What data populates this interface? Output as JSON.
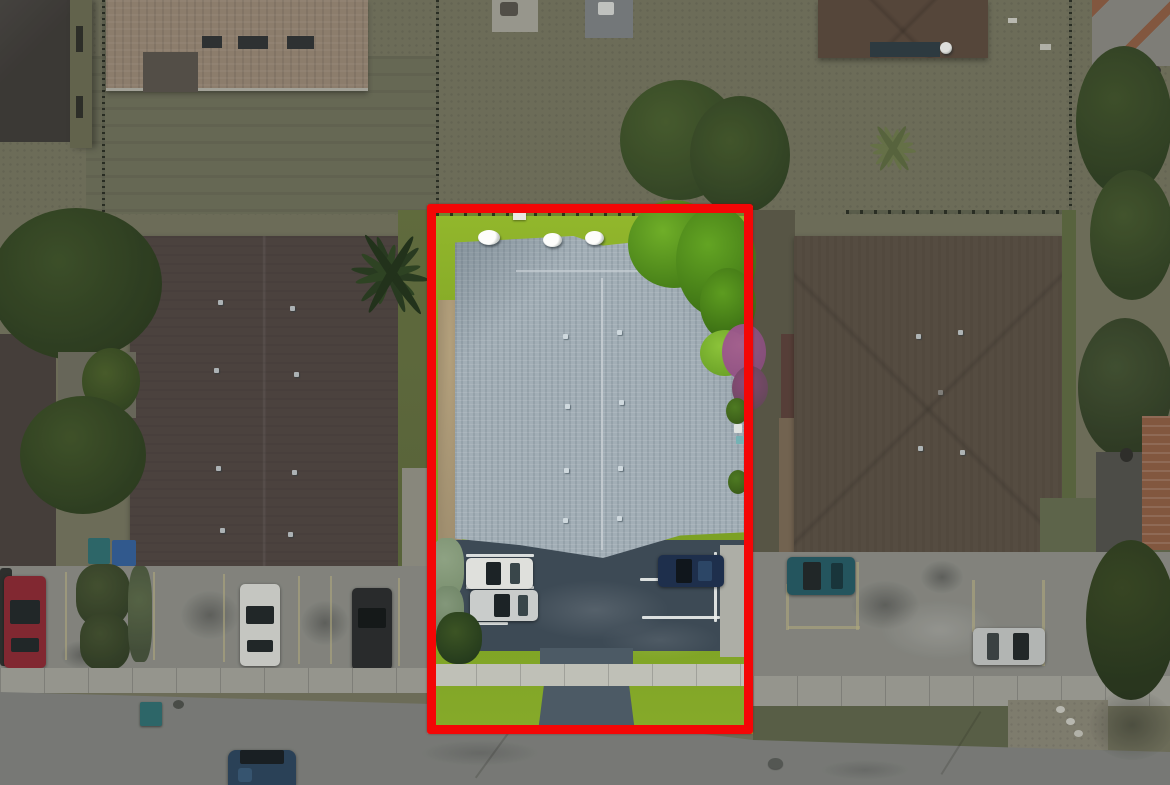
{
  "scene": {
    "type": "aerial-drone-photo",
    "subject": "multifamily property parcel outlined in red",
    "setting": "residential neighborhood with street at bottom",
    "effect": "area outside the red boundary is dimmed and desaturated"
  },
  "boundary": {
    "shape": "rectangle",
    "color": "#f40606",
    "x": 427,
    "y": 204,
    "width": 326,
    "height": 530,
    "thickness": 9
  },
  "palette": {
    "scrub": "#75755f",
    "lawn-muted": "#6e705a",
    "lawn-dark": "#5d6549",
    "grass-bright": "#81a526",
    "grass-lime": "#93b82c",
    "tree-dark": "#324722",
    "tree-mid": "#42572a",
    "tree-bright": "#4f8f1d",
    "tree-lime": "#8cc33a",
    "hedge-gray": "#7d9272",
    "palm-dark": "#243a1c",
    "palm-olive": "#6d7a4a",
    "roof-gray": "#a2aeb6",
    "roof-gray-dark": "#8799a4",
    "ridge-light": "#c9d0d5",
    "roof-brown-left": "#4e4340",
    "roof-brown-right": "#5a4f43",
    "roof-tan": "#9b8976",
    "roof-darkhouse": "#3b3835",
    "olive-wall": "#696b50",
    "terracotta": "#8f5c41",
    "asphalt": "#3d4a55",
    "asphalt-light": "#4c5a65",
    "concrete": "#8f908a",
    "sidewalk-out": "#a6a69e",
    "sidewalk-in": "#bfc0b7",
    "street": "#828481",
    "stripe-white": "#e9edec",
    "stripe-yellow": "#c9c08a",
    "red-line": "#f40606",
    "car-red": "#8e2430",
    "car-white": "#dfe0dc",
    "car-silver": "#c9cccb",
    "car-black": "#25282a",
    "car-navy": "#1e2f4c",
    "car-teal": "#1f5a66",
    "car-blue": "#27425e",
    "glass": "#1c2326",
    "dirt-tan": "#b3a07c",
    "dirt-path": "#7c6a55",
    "magenta": "#96518a",
    "pool-dark": "#2a3a42",
    "bin-teal": "#2a6e72",
    "bin-blue": "#2f5f9e",
    "white": "#eef0ee"
  },
  "objects": {
    "buildings": [
      {
        "name": "subject-building",
        "roof": "light gray shingle, center ridge",
        "location": "center of outlined parcel",
        "rooftop_items": "3 white satellite dishes on rear edge"
      },
      {
        "name": "left-apartment-building",
        "roof": "dark brown",
        "location": "left of parcel"
      },
      {
        "name": "right-apartment-building",
        "roof": "warm brown hip",
        "location": "right of parcel"
      },
      {
        "name": "top-left-house",
        "roof": "dark charcoal with olive wall"
      },
      {
        "name": "top-tan-tile-house",
        "roof": "tan tile with dark skylights"
      },
      {
        "name": "top-right-hip-house",
        "roof": "brown hip with satellite dish"
      },
      {
        "name": "far-top-right-house",
        "roof": "gray with terracotta"
      },
      {
        "name": "bottom-right-house",
        "roof": "gray + terracotta tile"
      }
    ],
    "vehicles": [
      {
        "color": "white",
        "location": "parcel lot, upper-left stall"
      },
      {
        "color": "silver",
        "location": "parcel lot, lower-left stall"
      },
      {
        "color": "navy",
        "location": "parcel lot, right stall"
      },
      {
        "color": "red",
        "location": "left neighbor lot"
      },
      {
        "color": "white",
        "location": "left neighbor lot"
      },
      {
        "color": "black",
        "location": "left neighbor lot"
      },
      {
        "color": "teal",
        "location": "right neighbor lot"
      },
      {
        "color": "silver",
        "location": "right neighbor lot"
      },
      {
        "color": "dark blue",
        "location": "street, bottom center, driving"
      }
    ],
    "landscape": [
      "bright lawn inside boundary",
      "dense green tree cluster at parcel rear-right corner",
      "magenta flowering tree on right edge of parcel",
      "palm tree overhanging left boundary",
      "muted scrubby lawns and fences outside boundary"
    ],
    "features": [
      "chain-link fences along rear property lines",
      "white striped parking stalls inside parcel",
      "yellow striped stalls in neighbor lots",
      "continuous sidewalk across bottom",
      "driveway from parcel lot to street",
      "teal dumpster at curb",
      "manhole cover in street"
    ]
  }
}
